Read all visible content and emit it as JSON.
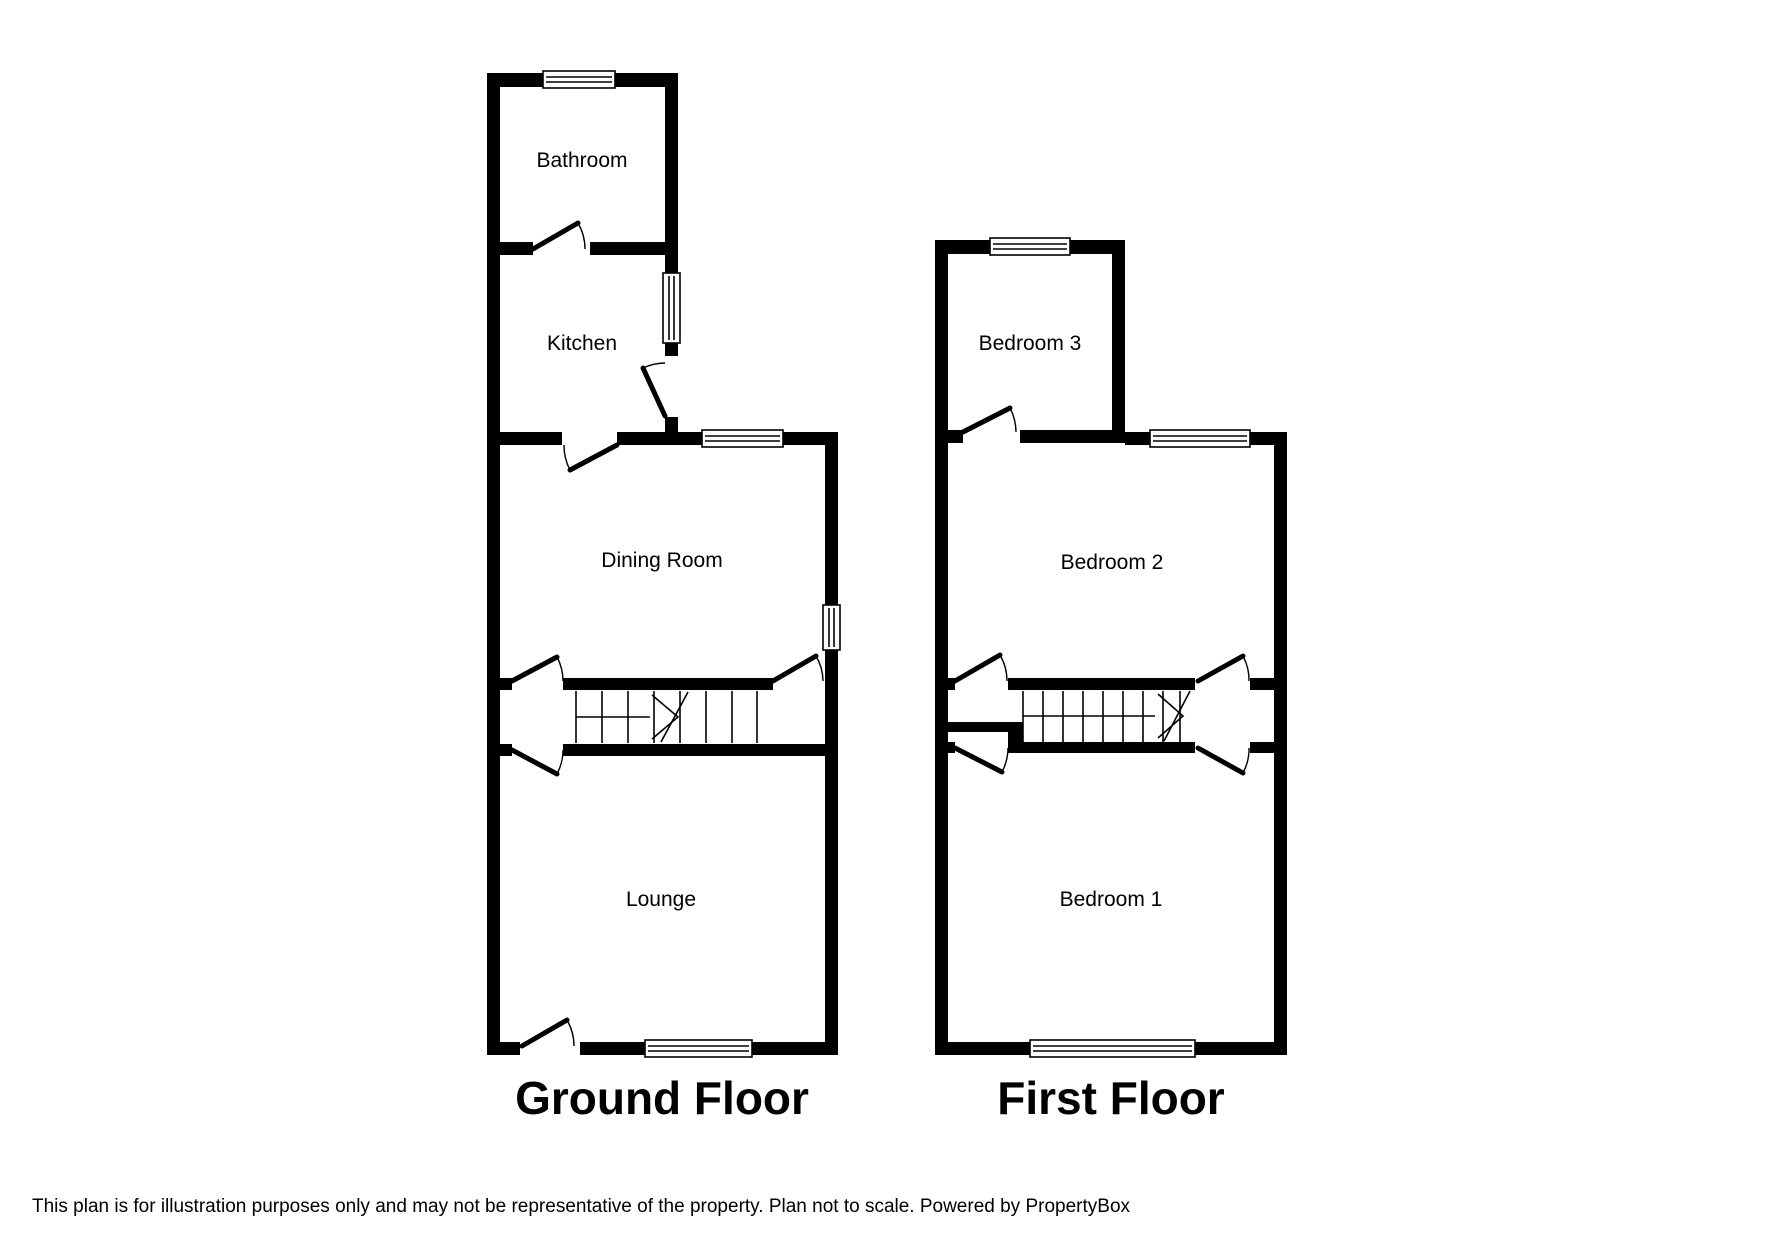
{
  "page": {
    "background_color": "#ffffff",
    "wall_color": "#000000"
  },
  "floors": [
    {
      "id": "ground",
      "label": "Ground Floor",
      "rooms": [
        {
          "name": "Bathroom"
        },
        {
          "name": "Kitchen"
        },
        {
          "name": "Dining Room"
        },
        {
          "name": "Lounge"
        }
      ]
    },
    {
      "id": "first",
      "label": "First Floor",
      "rooms": [
        {
          "name": "Bedroom 3"
        },
        {
          "name": "Bedroom 2"
        },
        {
          "name": "Bedroom 1"
        }
      ]
    }
  ],
  "disclaimer": "This plan is for illustration purposes only and may not be representative of the property. Plan not to scale. Powered by PropertyBox"
}
